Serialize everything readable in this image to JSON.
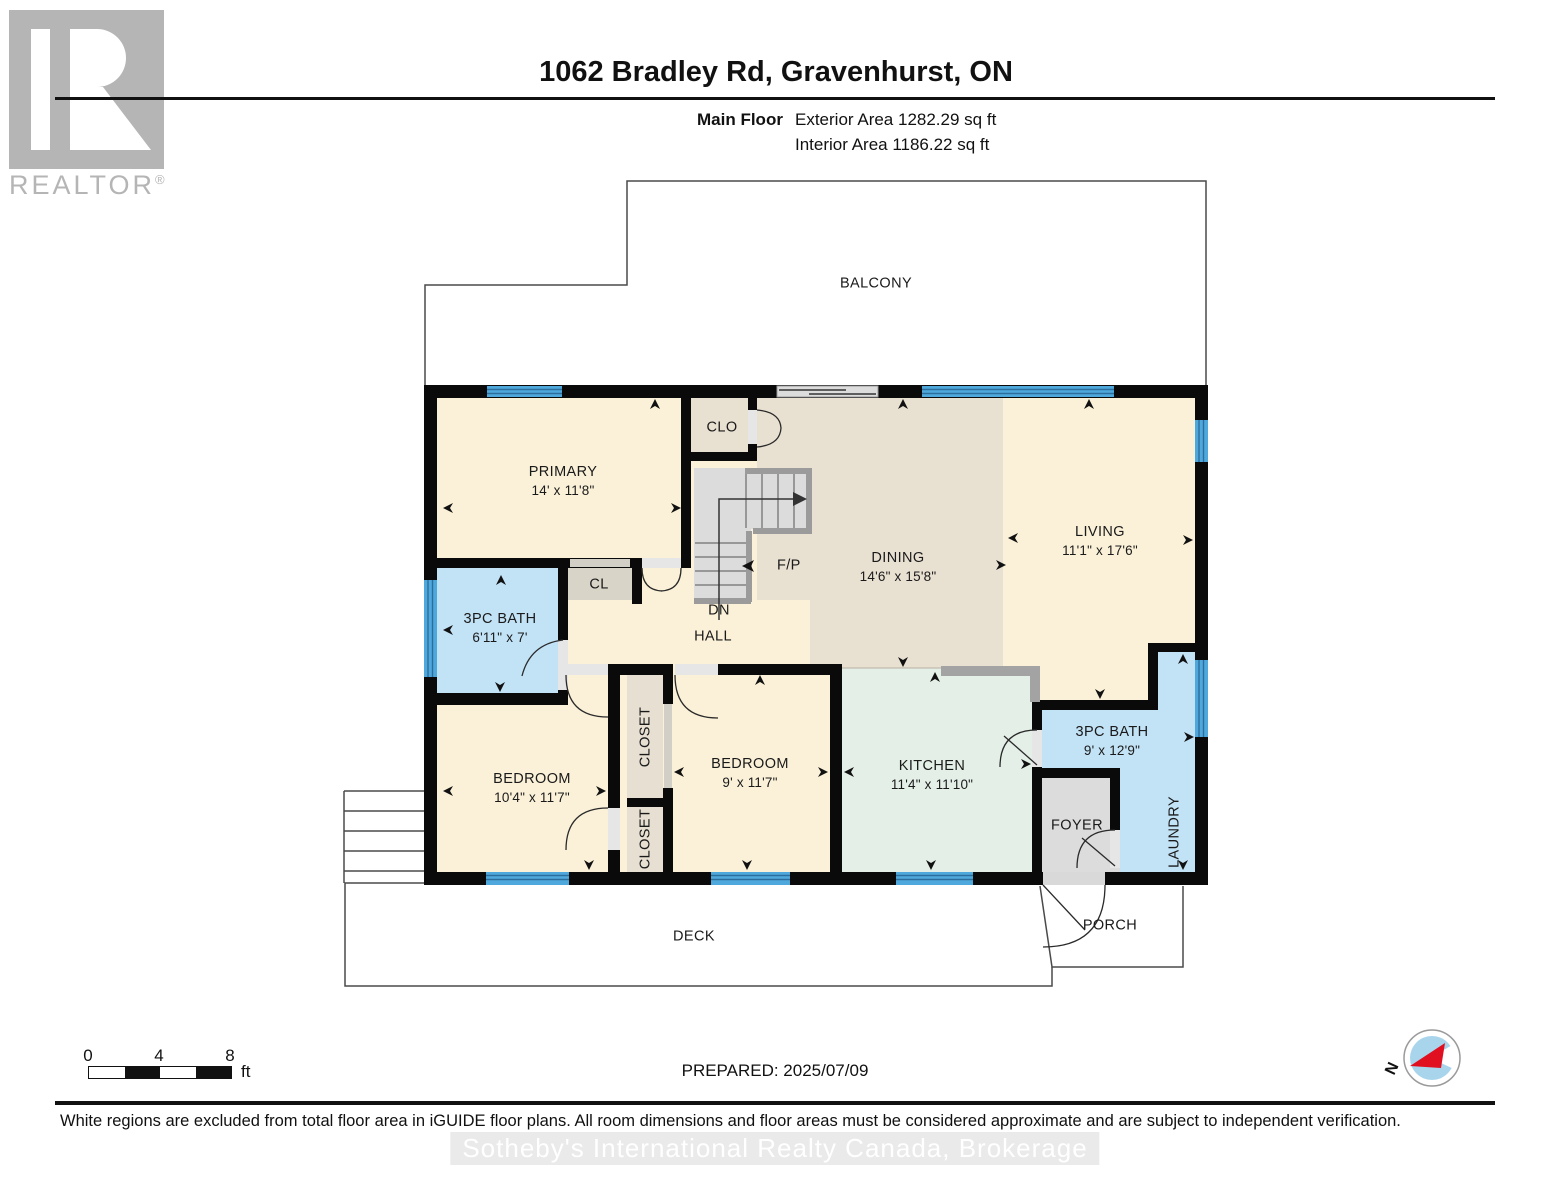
{
  "header": {
    "title": "1062 Bradley Rd, Gravenhurst, ON",
    "floor_label": "Main Floor",
    "exterior_area": "Exterior Area 1282.29 sq ft",
    "interior_area": "Interior Area 1186.22 sq ft"
  },
  "branding": {
    "realtor_logo_text": "REALTOR",
    "registered_mark": "®"
  },
  "rooms": {
    "balcony": {
      "name": "BALCONY"
    },
    "primary": {
      "name": "PRIMARY",
      "dims": "14' x 11'8\""
    },
    "clo": {
      "name": "CLO"
    },
    "cl": {
      "name": "CL"
    },
    "bath_main": {
      "name": "3PC BATH",
      "dims": "6'11\" x 7'"
    },
    "dining": {
      "name": "DINING",
      "dims": "14'6\" x 15'8\""
    },
    "living": {
      "name": "LIVING",
      "dims": "11'1\" x 17'6\""
    },
    "hall": {
      "name": "HALL"
    },
    "dn": {
      "name": "DN"
    },
    "fp": {
      "name": "F/P"
    },
    "bedroom1": {
      "name": "BEDROOM",
      "dims": "10'4\" x 11'7\""
    },
    "bedroom2": {
      "name": "BEDROOM",
      "dims": "9' x 11'7\""
    },
    "closet_top": {
      "name": "CLOSET"
    },
    "closet_bottom": {
      "name": "CLOSET"
    },
    "kitchen": {
      "name": "KITCHEN",
      "dims": "11'4\" x 11'10\""
    },
    "bath2": {
      "name": "3PC BATH",
      "dims": "9' x 12'9\""
    },
    "foyer": {
      "name": "FOYER"
    },
    "laundry": {
      "name": "LAUNDRY"
    },
    "deck": {
      "name": "DECK"
    },
    "porch": {
      "name": "PORCH"
    }
  },
  "footer": {
    "scale_ticks": [
      "0",
      "4",
      "8"
    ],
    "scale_unit": "ft",
    "prepared": "PREPARED: 2025/07/09",
    "compass_north": "N",
    "disclaimer": "White regions are excluded from total floor area in iGUIDE floor plans. All room dimensions and floor areas must be considered approximate and are subject to independent verification.",
    "watermark": "Sotheby's International Realty Canada, Brokerage"
  },
  "colors": {
    "wall": "#0a0a0a",
    "window_blue": "#4fa8dc",
    "room_cream": "#faf1d8",
    "room_tan": "#e8e0d1",
    "room_blue": "#c2e2f6",
    "room_mint": "#e4efe8",
    "room_gray": "#dcdcdc",
    "logo_gray": "#b5b5b5",
    "compass_blue": "#a9d5ec",
    "needle_red": "#e01020"
  }
}
